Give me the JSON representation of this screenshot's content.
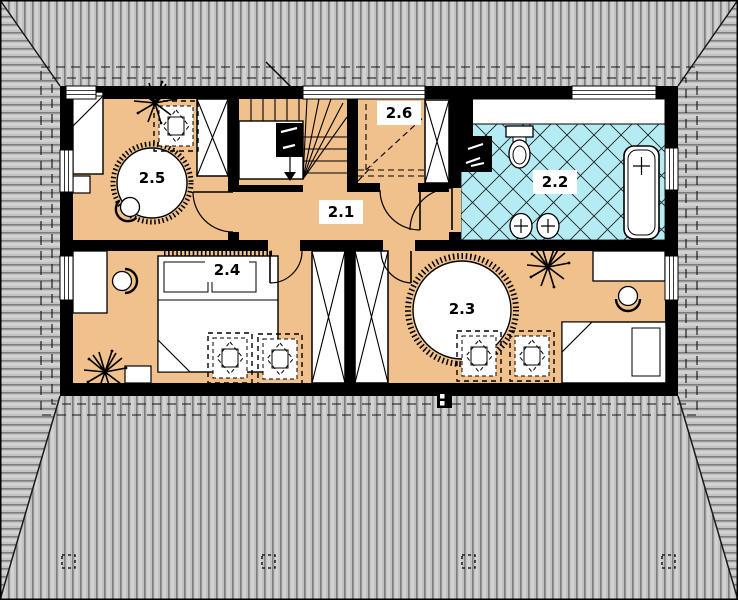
{
  "plan": {
    "type": "architectural-floor-plan-upper-storey",
    "floor_labels": {
      "hall": "2.1",
      "bathroom": "2.2",
      "bedroom_east": "2.3",
      "bedroom_west": "2.4",
      "bedroom_northwest": "2.5",
      "storage": "2.6"
    },
    "colors": {
      "floor": "#f0c18c",
      "tile_floor": "#b5ecf4",
      "roof_base": "#c2c2c2",
      "roof_line_dark": "#7d7d7d",
      "roof_line_light": "#d2d2d2",
      "wall": "#000000"
    }
  }
}
